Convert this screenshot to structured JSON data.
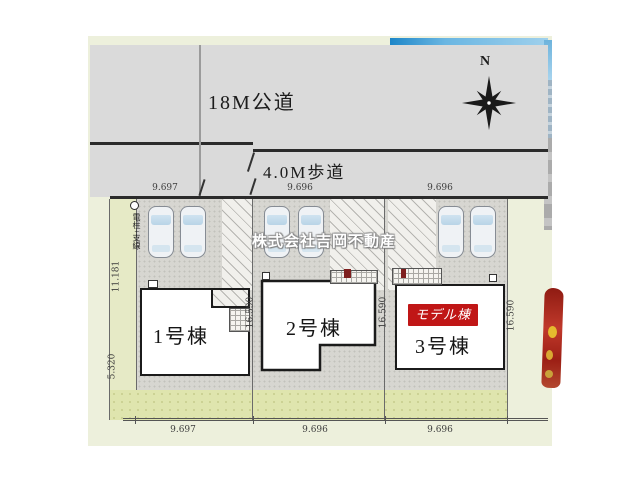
{
  "plan": {
    "road_label": "18M公道",
    "sidewalk_label": "4.0M歩道",
    "compass_n": "N",
    "pole_label": "電柱+支線",
    "watermark": "株式会社吉岡不動産",
    "buildings": [
      {
        "label": "1号棟"
      },
      {
        "label": "2号棟"
      },
      {
        "label": "3号棟",
        "badge": "モデル棟"
      }
    ],
    "dims": {
      "top": [
        "9.697",
        "9.696",
        "9.696"
      ],
      "bottom": [
        "9.697",
        "9.696",
        "9.696"
      ],
      "left_upper": "11.181",
      "left_lower": "5.320",
      "lot_depths": [
        "16.590",
        "16.590",
        "16.590"
      ]
    },
    "colors": {
      "road_gray": "#dadada",
      "site_bg": "#edf0dc",
      "paving": "#d7d6d1",
      "garden": "#dfe5ae",
      "badge_red": "#c01616",
      "flag_red": "#b02018"
    }
  }
}
